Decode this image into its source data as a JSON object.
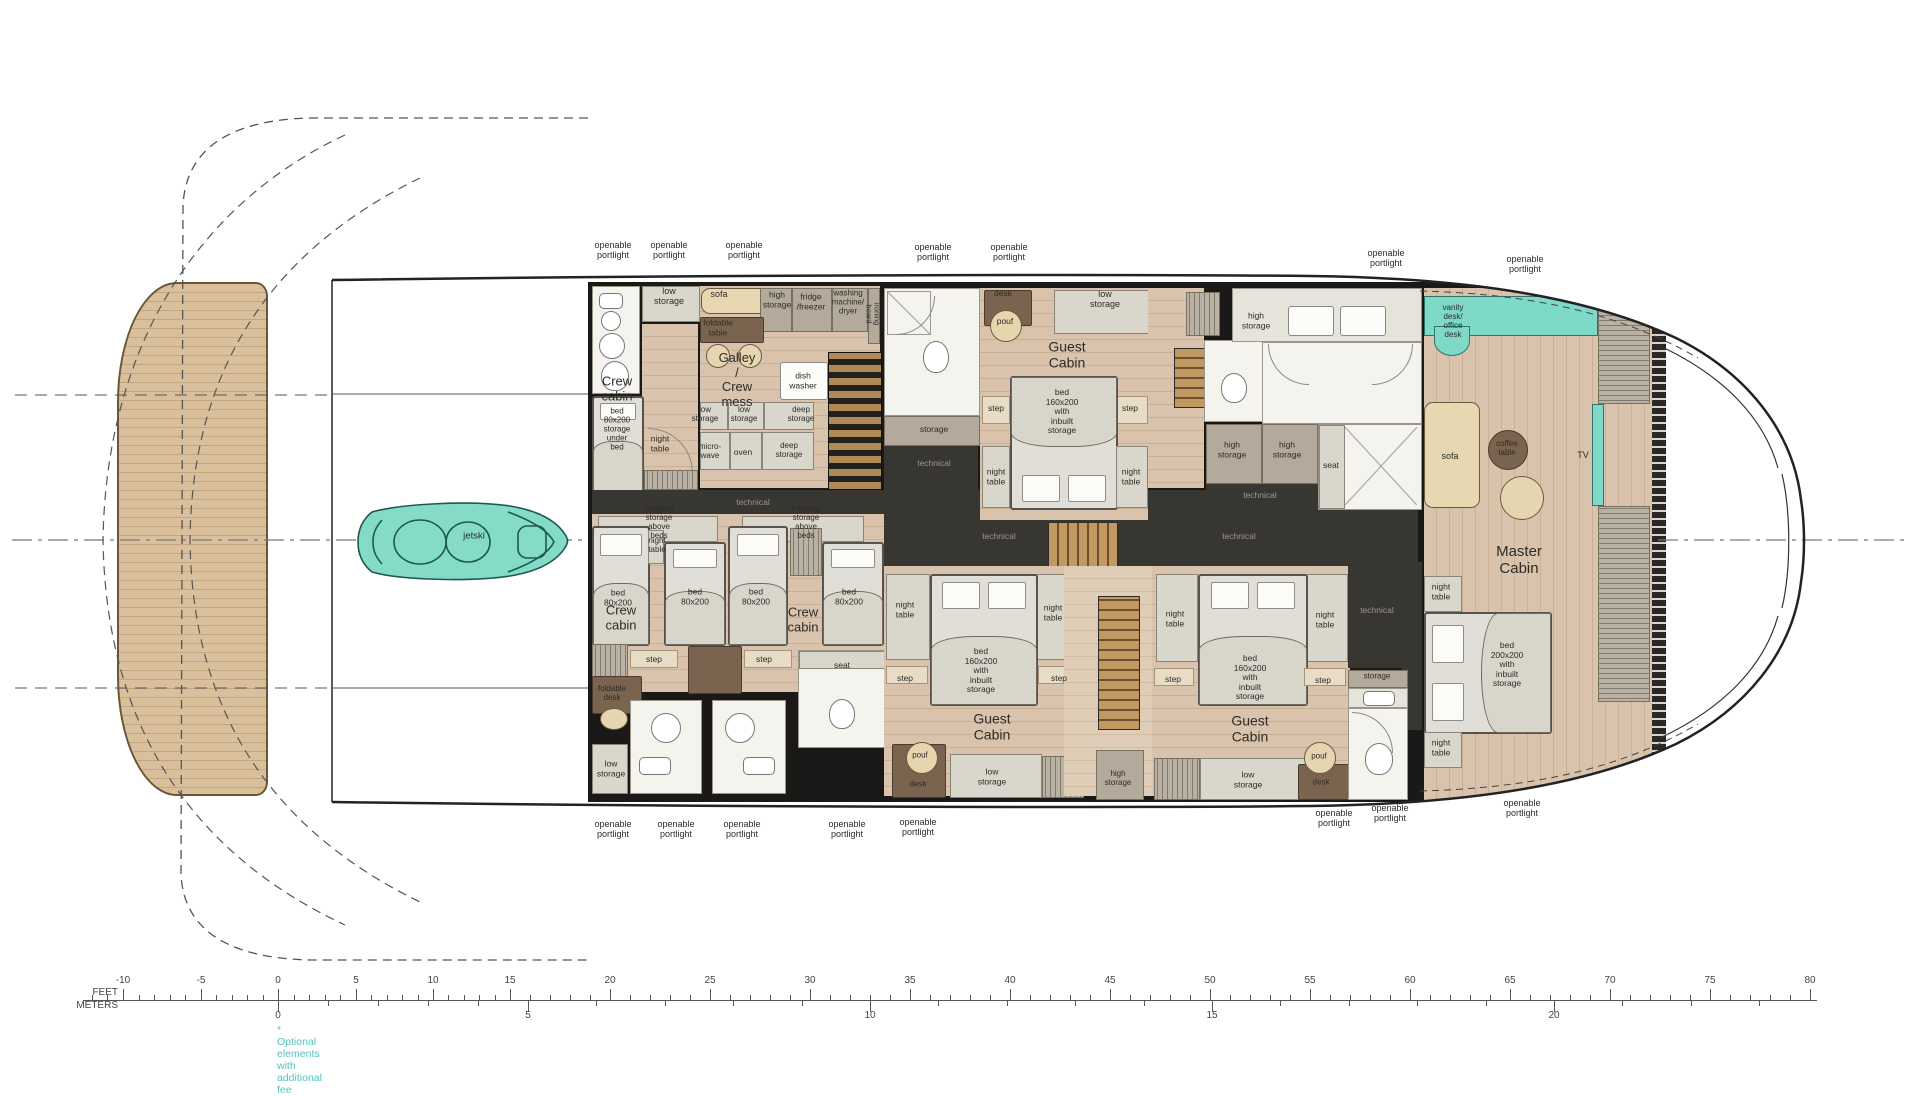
{
  "colors": {
    "accent_teal": "#7fd9c9",
    "note_teal": "#53c3c3",
    "wood": "#d9c3ac",
    "teak": "#d9bf9b",
    "wall_dark": "#1b1918",
    "technical_dark": "#383631",
    "bed_gray": "#e0ded6",
    "sofa_tan": "#e8d8b2",
    "furniture_brown": "#7a6450"
  },
  "labels": [
    {
      "n": "portlight-top-1",
      "t": "openable\nportlight",
      "x": 613,
      "y": 250,
      "fs": 9
    },
    {
      "n": "portlight-top-2",
      "t": "openable\nportlight",
      "x": 669,
      "y": 250,
      "fs": 9
    },
    {
      "n": "portlight-top-3",
      "t": "openable\nportlight",
      "x": 744,
      "y": 250,
      "fs": 9
    },
    {
      "n": "portlight-top-4",
      "t": "openable\nportlight",
      "x": 933,
      "y": 252,
      "fs": 9
    },
    {
      "n": "portlight-top-5",
      "t": "openable\nportlight",
      "x": 1009,
      "y": 252,
      "fs": 9
    },
    {
      "n": "portlight-top-6",
      "t": "openable\nportlight",
      "x": 1386,
      "y": 258,
      "fs": 9
    },
    {
      "n": "portlight-top-7",
      "t": "openable\nportlight",
      "x": 1525,
      "y": 264,
      "fs": 9
    },
    {
      "n": "portlight-bottom-1",
      "t": "openable\nportlight",
      "x": 613,
      "y": 829,
      "fs": 9
    },
    {
      "n": "portlight-bottom-2",
      "t": "openable\nportlight",
      "x": 676,
      "y": 829,
      "fs": 9
    },
    {
      "n": "portlight-bottom-3",
      "t": "openable\nportlight",
      "x": 742,
      "y": 829,
      "fs": 9
    },
    {
      "n": "portlight-bottom-4",
      "t": "openable\nportlight",
      "x": 847,
      "y": 829,
      "fs": 9
    },
    {
      "n": "portlight-bottom-5",
      "t": "openable\nportlight",
      "x": 918,
      "y": 827,
      "fs": 9
    },
    {
      "n": "portlight-bottom-6",
      "t": "openable\nportlight",
      "x": 1334,
      "y": 818,
      "fs": 9
    },
    {
      "n": "portlight-bottom-7",
      "t": "openable\nportlight",
      "x": 1390,
      "y": 813,
      "fs": 9
    },
    {
      "n": "portlight-bottom-8",
      "t": "openable\nportlight",
      "x": 1522,
      "y": 808,
      "fs": 9
    },
    {
      "n": "low-storage-top",
      "t": "low\nstorage",
      "x": 669,
      "y": 296,
      "fs": 9
    },
    {
      "n": "crew-cabin-1-title",
      "t": "Crew\ncabin",
      "x": 617,
      "y": 389,
      "fs": 13
    },
    {
      "n": "crew-bed-1",
      "t": "bed 80x200\nstorage\nunder bed",
      "x": 617,
      "y": 430,
      "fs": 8
    },
    {
      "n": "night-table-crew-1",
      "t": "night\ntable",
      "x": 660,
      "y": 444,
      "fs": 8.5
    },
    {
      "n": "sofa-galley",
      "t": "sofa",
      "x": 719,
      "y": 294,
      "fs": 9
    },
    {
      "n": "foldable-table",
      "t": "foldable\ntable",
      "x": 718,
      "y": 328,
      "fs": 8.5
    },
    {
      "n": "galley-title",
      "t": "Galley /\nCrew mess",
      "x": 737,
      "y": 380,
      "fs": 13
    },
    {
      "n": "high-storage-galley",
      "t": "high\nstorage",
      "x": 777,
      "y": 300,
      "fs": 8.5
    },
    {
      "n": "fridge-freezer",
      "t": "fridge\n/freezer",
      "x": 811,
      "y": 302,
      "fs": 8.5
    },
    {
      "n": "washing-machine",
      "t": "washing\nmachine/\ndryer",
      "x": 848,
      "y": 303,
      "fs": 8
    },
    {
      "n": "ironing-board",
      "t": "ironing board",
      "x": 872,
      "y": 314,
      "fs": 7.5,
      "rot": true
    },
    {
      "n": "dish-washer",
      "t": "dish\nwasher",
      "x": 803,
      "y": 381,
      "fs": 8.5
    },
    {
      "n": "low-storage-galley-1",
      "t": "low\nstorage",
      "x": 705,
      "y": 415,
      "fs": 8
    },
    {
      "n": "low-storage-galley-2",
      "t": "low\nstorage",
      "x": 744,
      "y": 415,
      "fs": 8
    },
    {
      "n": "deep-storage-galley-1",
      "t": "deep\nstorage",
      "x": 801,
      "y": 415,
      "fs": 8
    },
    {
      "n": "micro-wave",
      "t": "micro-\nwave",
      "x": 710,
      "y": 452,
      "fs": 8
    },
    {
      "n": "oven",
      "t": "oven",
      "x": 743,
      "y": 453,
      "fs": 8.5
    },
    {
      "n": "deep-storage-galley-2",
      "t": "deep\nstorage",
      "x": 789,
      "y": 451,
      "fs": 8
    },
    {
      "n": "technical-1",
      "t": "technical",
      "x": 753,
      "y": 503,
      "fs": 8.5,
      "lt": true
    },
    {
      "n": "hanging-storage-1",
      "t": "hanging storage above beds",
      "x": 659,
      "y": 523,
      "fs": 8
    },
    {
      "n": "hanging-storage-2",
      "t": "hanging storage above beds",
      "x": 806,
      "y": 523,
      "fs": 8
    },
    {
      "n": "night-table-crew-2",
      "t": "night\ntable",
      "x": 657,
      "y": 546,
      "fs": 8
    },
    {
      "n": "bed-80-1",
      "t": "bed\n80x200",
      "x": 618,
      "y": 598,
      "fs": 8.5
    },
    {
      "n": "bed-80-2",
      "t": "bed\n80x200",
      "x": 695,
      "y": 597,
      "fs": 8.5
    },
    {
      "n": "bed-80-3",
      "t": "bed\n80x200",
      "x": 756,
      "y": 597,
      "fs": 8.5
    },
    {
      "n": "bed-80-4",
      "t": "bed\n80x200",
      "x": 849,
      "y": 597,
      "fs": 8.5
    },
    {
      "n": "crew-cabin-2-title",
      "t": "Crew\ncabin",
      "x": 621,
      "y": 618,
      "fs": 13
    },
    {
      "n": "crew-cabin-3-title",
      "t": "Crew\ncabin",
      "x": 803,
      "y": 620,
      "fs": 13
    },
    {
      "n": "step-crew-1",
      "t": "step",
      "x": 654,
      "y": 660,
      "fs": 8.5
    },
    {
      "n": "step-crew-2",
      "t": "step",
      "x": 764,
      "y": 660,
      "fs": 8.5
    },
    {
      "n": "foldable-desk",
      "t": "foldable\ndesk",
      "x": 612,
      "y": 694,
      "fs": 8
    },
    {
      "n": "seat-crew-shower",
      "t": "seat",
      "x": 842,
      "y": 666,
      "fs": 8.5
    },
    {
      "n": "low-storage-crew-bl",
      "t": "low\nstorage",
      "x": 611,
      "y": 769,
      "fs": 8.5
    },
    {
      "n": "desk-guest-top",
      "t": "desk",
      "x": 1003,
      "y": 294,
      "fs": 8.5
    },
    {
      "n": "pouf-guest-top",
      "t": "pouf",
      "x": 1005,
      "y": 322,
      "fs": 8.5
    },
    {
      "n": "low-storage-guest-top",
      "t": "low storage",
      "x": 1105,
      "y": 299,
      "fs": 9
    },
    {
      "n": "guest-cabin-top-title",
      "t": "Guest Cabin",
      "x": 1067,
      "y": 355,
      "fs": 14
    },
    {
      "n": "bed-guest-top",
      "t": "bed 160x200\nwith inbuilt\nstorage",
      "x": 1062,
      "y": 412,
      "fs": 8.5
    },
    {
      "n": "step-guest-top-1",
      "t": "step",
      "x": 996,
      "y": 409,
      "fs": 8.5
    },
    {
      "n": "step-guest-top-2",
      "t": "step",
      "x": 1130,
      "y": 409,
      "fs": 8.5
    },
    {
      "n": "night-table-guest-top-1",
      "t": "night\ntable",
      "x": 996,
      "y": 477,
      "fs": 8.5
    },
    {
      "n": "night-table-guest-top-2",
      "t": "night\ntable",
      "x": 1131,
      "y": 477,
      "fs": 8.5
    },
    {
      "n": "storage-top-bath",
      "t": "storage",
      "x": 934,
      "y": 430,
      "fs": 8.5
    },
    {
      "n": "technical-2",
      "t": "technical",
      "x": 934,
      "y": 464,
      "fs": 8.5,
      "lt": true
    },
    {
      "n": "high-storage-mbath-1",
      "t": "high\nstorage",
      "x": 1256,
      "y": 321,
      "fs": 8.5
    },
    {
      "n": "vanity-desk",
      "t": "vanity desk/\noffice desk",
      "x": 1453,
      "y": 322,
      "fs": 8
    },
    {
      "n": "high-storage-mbath-2",
      "t": "high\nstorage",
      "x": 1232,
      "y": 450,
      "fs": 8.5
    },
    {
      "n": "high-storage-mbath-3",
      "t": "high\nstorage",
      "x": 1287,
      "y": 450,
      "fs": 8.5
    },
    {
      "n": "seat-master-shower",
      "t": "seat",
      "x": 1331,
      "y": 466,
      "fs": 8.5
    },
    {
      "n": "technical-3",
      "t": "technical",
      "x": 1260,
      "y": 496,
      "fs": 8.5,
      "lt": true
    },
    {
      "n": "sofa-master",
      "t": "sofa",
      "x": 1450,
      "y": 456,
      "fs": 9
    },
    {
      "n": "coffee-table",
      "t": "coffee\ntable",
      "x": 1507,
      "y": 449,
      "fs": 8
    },
    {
      "n": "tv-master",
      "t": "TV",
      "x": 1583,
      "y": 455,
      "fs": 9
    },
    {
      "n": "master-cabin-title",
      "t": "Master\nCabin",
      "x": 1519,
      "y": 561,
      "fs": 15
    },
    {
      "n": "night-table-master-1",
      "t": "night\ntable",
      "x": 1441,
      "y": 592,
      "fs": 8.5
    },
    {
      "n": "bed-master",
      "t": "bed 200x200\nwith inbuilt\nstorage",
      "x": 1507,
      "y": 665,
      "fs": 8.5
    },
    {
      "n": "night-table-master-2",
      "t": "night\ntable",
      "x": 1441,
      "y": 748,
      "fs": 8.5
    },
    {
      "n": "technical-4",
      "t": "technical",
      "x": 1377,
      "y": 611,
      "fs": 8.5,
      "lt": true
    },
    {
      "n": "storage-br-bath",
      "t": "storage",
      "x": 1377,
      "y": 677,
      "fs": 8
    },
    {
      "n": "guest-cabin-br-title",
      "t": "Guest Cabin",
      "x": 1250,
      "y": 729,
      "fs": 14
    },
    {
      "n": "night-table-guest-br-1",
      "t": "night\ntable",
      "x": 1175,
      "y": 619,
      "fs": 8.5
    },
    {
      "n": "night-table-guest-br-2",
      "t": "night\ntable",
      "x": 1325,
      "y": 620,
      "fs": 8.5
    },
    {
      "n": "bed-guest-br",
      "t": "bed 160x200\nwith inbuilt\nstorage",
      "x": 1250,
      "y": 678,
      "fs": 8.5
    },
    {
      "n": "step-guest-br-1",
      "t": "step",
      "x": 1173,
      "y": 680,
      "fs": 8.5
    },
    {
      "n": "step-guest-br-2",
      "t": "step",
      "x": 1323,
      "y": 681,
      "fs": 8.5
    },
    {
      "n": "pouf-guest-br",
      "t": "pouf",
      "x": 1319,
      "y": 757,
      "fs": 8
    },
    {
      "n": "desk-guest-br",
      "t": "desk",
      "x": 1321,
      "y": 783,
      "fs": 8
    },
    {
      "n": "low-storage-guest-br",
      "t": "low storage",
      "x": 1248,
      "y": 780,
      "fs": 8.5
    },
    {
      "n": "high-storage-mid-bottom",
      "t": "high\nstorage",
      "x": 1118,
      "y": 779,
      "fs": 8
    },
    {
      "n": "guest-cabin-bl-title",
      "t": "Guest Cabin",
      "x": 992,
      "y": 727,
      "fs": 14
    },
    {
      "n": "night-table-guest-bl-1",
      "t": "night\ntable",
      "x": 905,
      "y": 610,
      "fs": 8.5
    },
    {
      "n": "night-table-guest-bl-2",
      "t": "night\ntable",
      "x": 1053,
      "y": 613,
      "fs": 8.5
    },
    {
      "n": "bed-guest-bl",
      "t": "bed 160x200\nwith inbuilt\nstorage",
      "x": 981,
      "y": 671,
      "fs": 8.5
    },
    {
      "n": "step-guest-bl-1",
      "t": "step",
      "x": 905,
      "y": 679,
      "fs": 8.5
    },
    {
      "n": "step-guest-bl-2",
      "t": "step",
      "x": 1059,
      "y": 679,
      "fs": 8.5
    },
    {
      "n": "pouf-guest-bl",
      "t": "pouf",
      "x": 920,
      "y": 756,
      "fs": 8
    },
    {
      "n": "desk-guest-bl",
      "t": "desk",
      "x": 918,
      "y": 785,
      "fs": 8
    },
    {
      "n": "low-storage-guest-bl",
      "t": "low\nstorage",
      "x": 992,
      "y": 777,
      "fs": 8.5
    },
    {
      "n": "technical-5",
      "t": "technical",
      "x": 999,
      "y": 537,
      "fs": 8.5,
      "lt": true
    },
    {
      "n": "technical-6",
      "t": "technical",
      "x": 1239,
      "y": 537,
      "fs": 8.5,
      "lt": true
    },
    {
      "n": "jetski",
      "t": "jetski",
      "x": 474,
      "y": 537,
      "fs": 9.5
    }
  ],
  "scale": {
    "feet_caption": "FEET",
    "meters_caption": "METERS",
    "note": "* Optional elements with additional fee",
    "feet_ticks": [
      {
        "label": "-10",
        "x": 123
      },
      {
        "label": "-5",
        "x": 201
      },
      {
        "label": "0",
        "x": 278
      },
      {
        "label": "5",
        "x": 356
      },
      {
        "label": "10",
        "x": 433
      },
      {
        "label": "15",
        "x": 510
      },
      {
        "label": "20",
        "x": 610
      },
      {
        "label": "25",
        "x": 710
      },
      {
        "label": "30",
        "x": 810
      },
      {
        "label": "35",
        "x": 910
      },
      {
        "label": "40",
        "x": 1010
      },
      {
        "label": "45",
        "x": 1110
      },
      {
        "label": "50",
        "x": 1210
      },
      {
        "label": "55",
        "x": 1310
      },
      {
        "label": "60",
        "x": 1410
      },
      {
        "label": "65",
        "x": 1510
      },
      {
        "label": "70",
        "x": 1610
      },
      {
        "label": "75",
        "x": 1710
      },
      {
        "label": "80",
        "x": 1810
      }
    ],
    "meters_ticks": [
      {
        "label": "0",
        "x": 278
      },
      {
        "label": "5",
        "x": 528
      },
      {
        "label": "10",
        "x": 870
      },
      {
        "label": "15",
        "x": 1212
      },
      {
        "label": "20",
        "x": 1554
      }
    ]
  }
}
